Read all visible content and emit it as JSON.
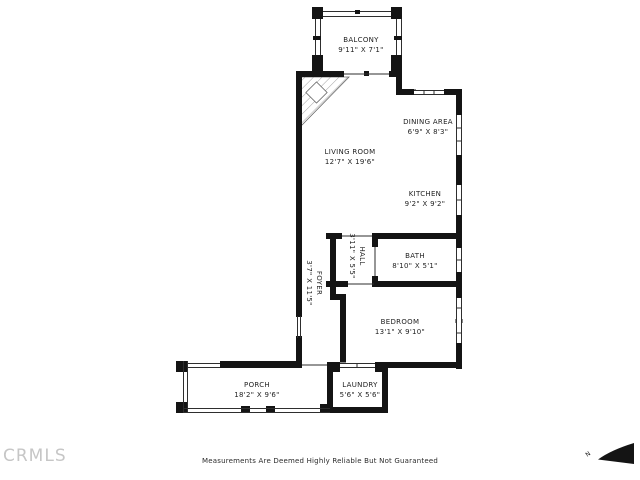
{
  "title": "Condominium floor plan",
  "rooms": {
    "balcony": {
      "name": "BALCONY",
      "dims": "9'11\" X 7'1\""
    },
    "dining": {
      "name": "DINING AREA",
      "dims": "6'9\" X 8'3\""
    },
    "living": {
      "name": "LIVING ROOM",
      "dims": "12'7\" X 19'6\""
    },
    "kitchen": {
      "name": "KITCHEN",
      "dims": "9'2\" X 9'2\""
    },
    "bath": {
      "name": "BATH",
      "dims": "8'10\" X 5'1\""
    },
    "hall": {
      "name": "HALL",
      "dims": "3'11\" X 5'5\""
    },
    "foyer": {
      "name": "FOYER",
      "dims": "3'7\" X 11'5\""
    },
    "bedroom": {
      "name": "BEDROOM",
      "dims": "13'1\" X 9'10\""
    },
    "porch": {
      "name": "PORCH",
      "dims": "18'2\" X 9'6\""
    },
    "laundry": {
      "name": "LAUNDRY",
      "dims": "5'6\" X 5'6\""
    }
  },
  "footer": {
    "watermark": "CRMLS",
    "disclaimer": "Measurements Are Deemed Highly Reliable But Not Guaranteed",
    "north_label": "N"
  },
  "colors": {
    "wall": "#141414",
    "thin_line": "#2e2e2e",
    "text": "#1f1f1f",
    "watermark": "#c6c6c6"
  }
}
